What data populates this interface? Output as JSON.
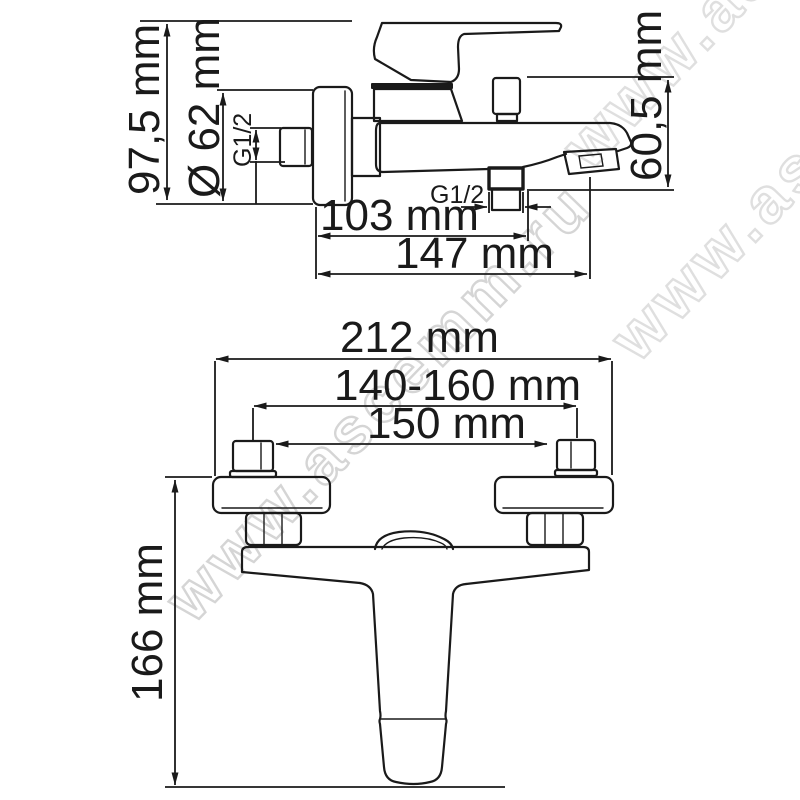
{
  "diagram": {
    "type": "technical-drawing",
    "subject": "wall-mounted bath mixer tap, side and front projections with dimensions",
    "background_color": "#ffffff",
    "line_color": "#1a1a1a",
    "side_view": {
      "dims": {
        "overall_height": "97,5 mm",
        "flange_diameter": "Ø 62 mm",
        "inlet_thread": "G1/2",
        "wall_to_shower_outlet": "103 mm",
        "wall_to_spout": "147 mm",
        "spout_drop": "60,5 mm",
        "shower_outlet_thread": "G1/2"
      }
    },
    "front_view": {
      "dims": {
        "overall_width": "212 mm",
        "adjustment_range": "140-160 mm",
        "connection_centers": "150 mm",
        "overall_height": "166 mm"
      }
    },
    "watermark": {
      "text": "www.ascemm.ru",
      "color": "#d5d5d5"
    }
  }
}
